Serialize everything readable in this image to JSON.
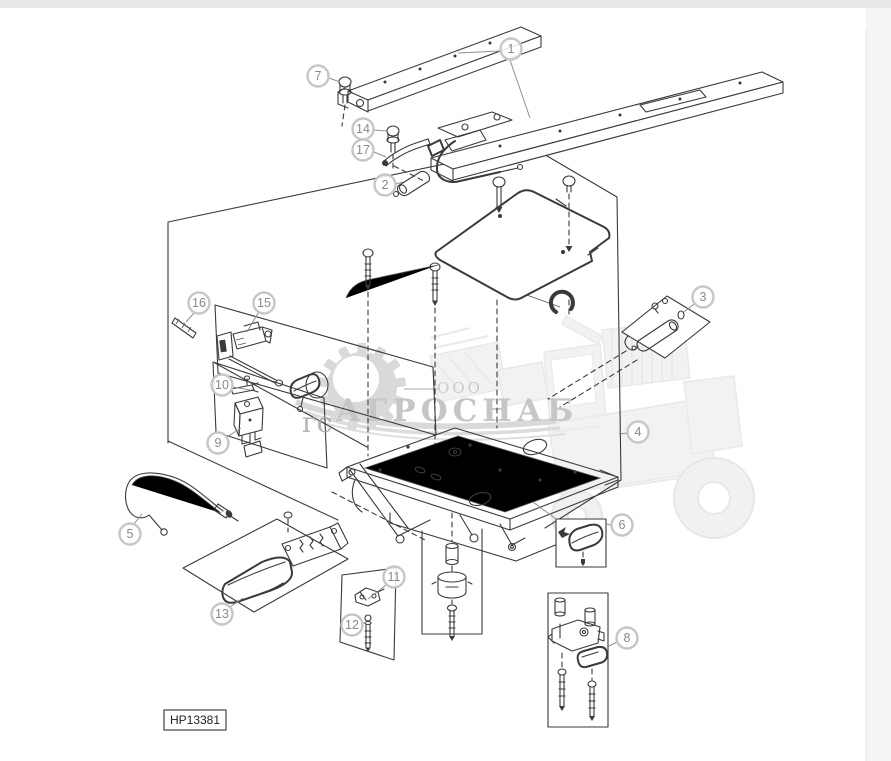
{
  "page": {
    "background": "#ffffff",
    "top_strip_color": "#e8e8e8",
    "side_strip_color": "#f5f5f6"
  },
  "watermark": {
    "ooo": "ООО",
    "brand": "АГРОСНАБ",
    "fragment": "гс",
    "color": "#c9c9c9"
  },
  "drawing_label": {
    "text": "HP13381"
  },
  "callouts": [
    {
      "n": "1",
      "cx": 511,
      "cy": 49,
      "leaders": [
        [
          500,
          51,
          458,
          53
        ],
        [
          510,
          60,
          530,
          118
        ]
      ]
    },
    {
      "n": "7",
      "cx": 318,
      "cy": 76,
      "leaders": [
        [
          329,
          78,
          340,
          82
        ]
      ]
    },
    {
      "n": "14",
      "cx": 363,
      "cy": 129,
      "leaders": [
        [
          374,
          130,
          388,
          131
        ]
      ]
    },
    {
      "n": "17",
      "cx": 363,
      "cy": 150,
      "leaders": [
        [
          374,
          152,
          386,
          157
        ]
      ]
    },
    {
      "n": "2",
      "cx": 385,
      "cy": 185,
      "leaders": [
        [
          396,
          184,
          403,
          182
        ]
      ]
    },
    {
      "n": "16",
      "cx": 199,
      "cy": 303,
      "leaders": [
        [
          194,
          313,
          186,
          322
        ]
      ]
    },
    {
      "n": "15",
      "cx": 264,
      "cy": 303,
      "leaders": [
        [
          258,
          313,
          247,
          332
        ]
      ]
    },
    {
      "n": "10",
      "cx": 222,
      "cy": 385,
      "leaders": [
        [
          233,
          387,
          250,
          390
        ]
      ]
    },
    {
      "n": "9",
      "cx": 218,
      "cy": 443,
      "leaders": [
        [
          227,
          437,
          241,
          428
        ]
      ]
    },
    {
      "n": "3",
      "cx": 703,
      "cy": 297,
      "leaders": [
        [
          694,
          304,
          684,
          312
        ]
      ]
    },
    {
      "n": "4",
      "cx": 638,
      "cy": 432,
      "leaders": [
        [
          627,
          433,
          619,
          434
        ]
      ]
    },
    {
      "n": "5",
      "cx": 130,
      "cy": 534,
      "leaders": [
        [
          134,
          524,
          142,
          514
        ]
      ]
    },
    {
      "n": "13",
      "cx": 222,
      "cy": 614,
      "leaders": [
        [
          230,
          607,
          243,
          598
        ]
      ]
    },
    {
      "n": "11",
      "cx": 394,
      "cy": 577,
      "leaders": [
        [
          386,
          585,
          368,
          599
        ]
      ]
    },
    {
      "n": "12",
      "cx": 352,
      "cy": 625,
      "leaders": [
        [
          362,
          624,
          366,
          622
        ]
      ]
    },
    {
      "n": "6",
      "cx": 622,
      "cy": 525,
      "leaders": [
        [
          611,
          525,
          606,
          524
        ]
      ]
    },
    {
      "n": "8",
      "cx": 627,
      "cy": 638,
      "leaders": [
        [
          617,
          642,
          609,
          646
        ]
      ]
    }
  ]
}
